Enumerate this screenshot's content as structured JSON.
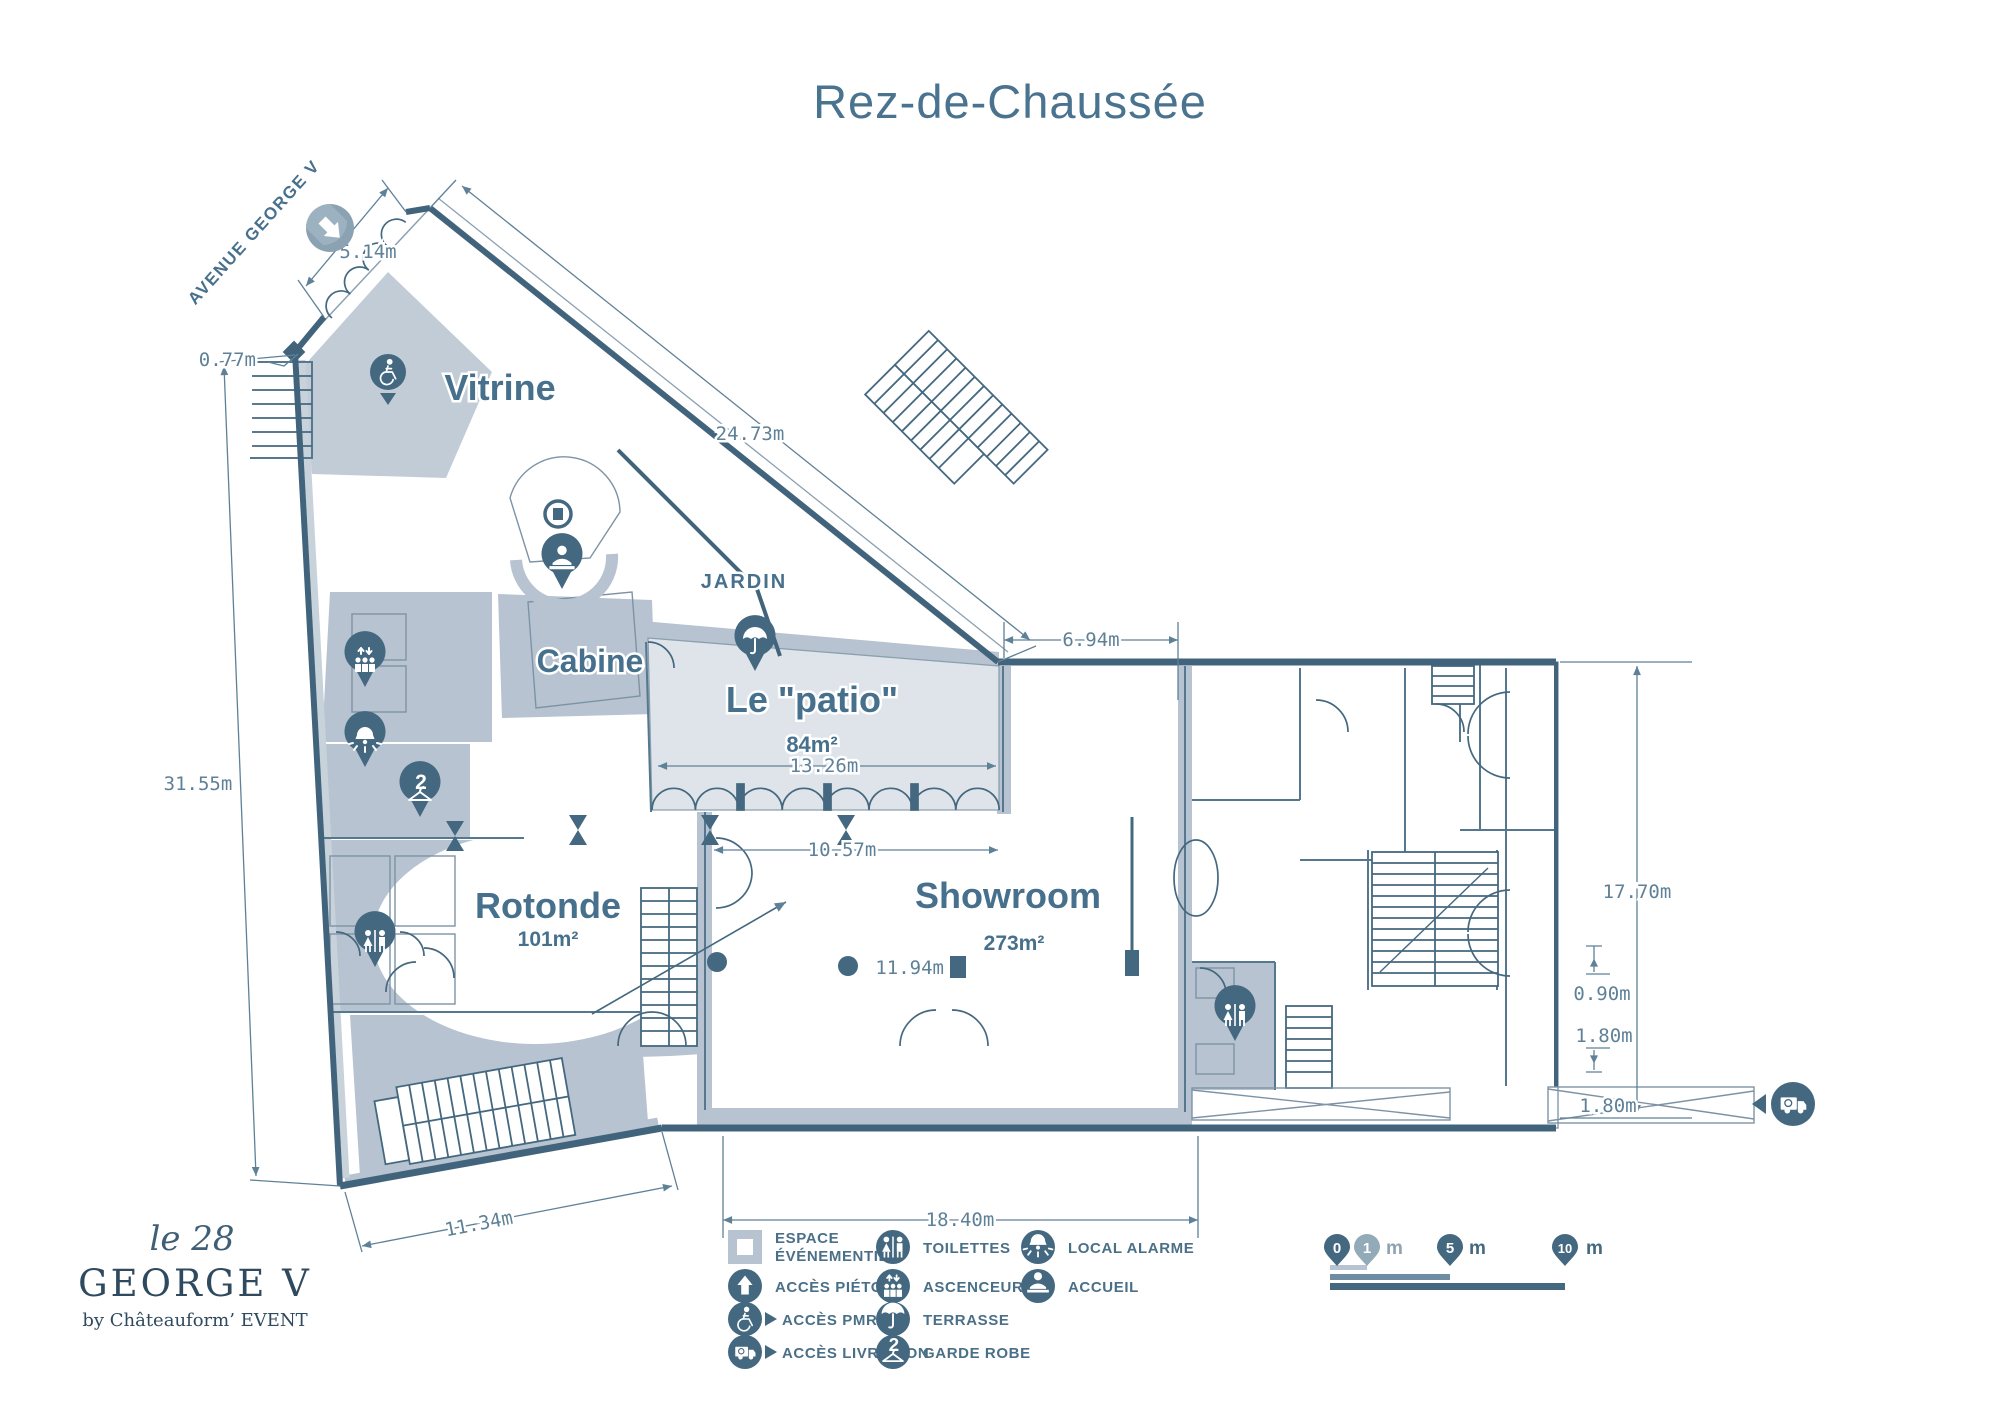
{
  "title": "Rez-de-Chaussée",
  "plan": {
    "street_label": "AVENUE GEORGE V",
    "rooms": {
      "vitrine": {
        "name": "Vitrine"
      },
      "cabine": {
        "name": "Cabine"
      },
      "patio": {
        "name": "Le \"patio\"",
        "area": "84m²"
      },
      "jardin": {
        "name": "JARDIN"
      },
      "rotonde": {
        "name": "Rotonde",
        "area": "101m²"
      },
      "showroom": {
        "name": "Showroom",
        "area": "273m²"
      }
    },
    "dimensions": {
      "entrance_width": "5.14m",
      "wall_offset": "0.77m",
      "facade_diagonal": "24.73m",
      "left_wall": "31.55m",
      "top_right_span": "6.94m",
      "patio_width": "13.26m",
      "showroom_upper_width": "10.57m",
      "showroom_depth": "11.94m",
      "showroom_width": "18.40m",
      "bottom_left_wall": "11.34m",
      "right_wing_depth": "17.70m",
      "niche_depth": "0.90m",
      "niche_height": "1.80m",
      "ramp_width": "1.80m"
    }
  },
  "legend": {
    "items": [
      {
        "label": "ESPACE",
        "label2": "ÉVÉNEMENTIEL"
      },
      {
        "label": "ACCÈS PIÉTON"
      },
      {
        "label": "ACCÈS PMR"
      },
      {
        "label": "ACCÈS LIVRAISON"
      },
      {
        "label": "TOILETTES"
      },
      {
        "label": "ASCENCEUR"
      },
      {
        "label": "TERRASSE"
      },
      {
        "label": "GARDE ROBE"
      },
      {
        "label": "LOCAL ALARME"
      },
      {
        "label": "ACCUEIL"
      }
    ]
  },
  "scale_bar": {
    "zero": "0",
    "one": "1",
    "five": "5",
    "ten": "10",
    "unit": "m"
  },
  "logo": {
    "script": "le 28",
    "name": "GEORGE V",
    "byline": "by Châteauform’ EVENT"
  },
  "colors": {
    "ink": "#44687f",
    "poche": "#b7c3d0",
    "patio_fill": "#dfe4ea",
    "accent_light": "#93aab9"
  }
}
